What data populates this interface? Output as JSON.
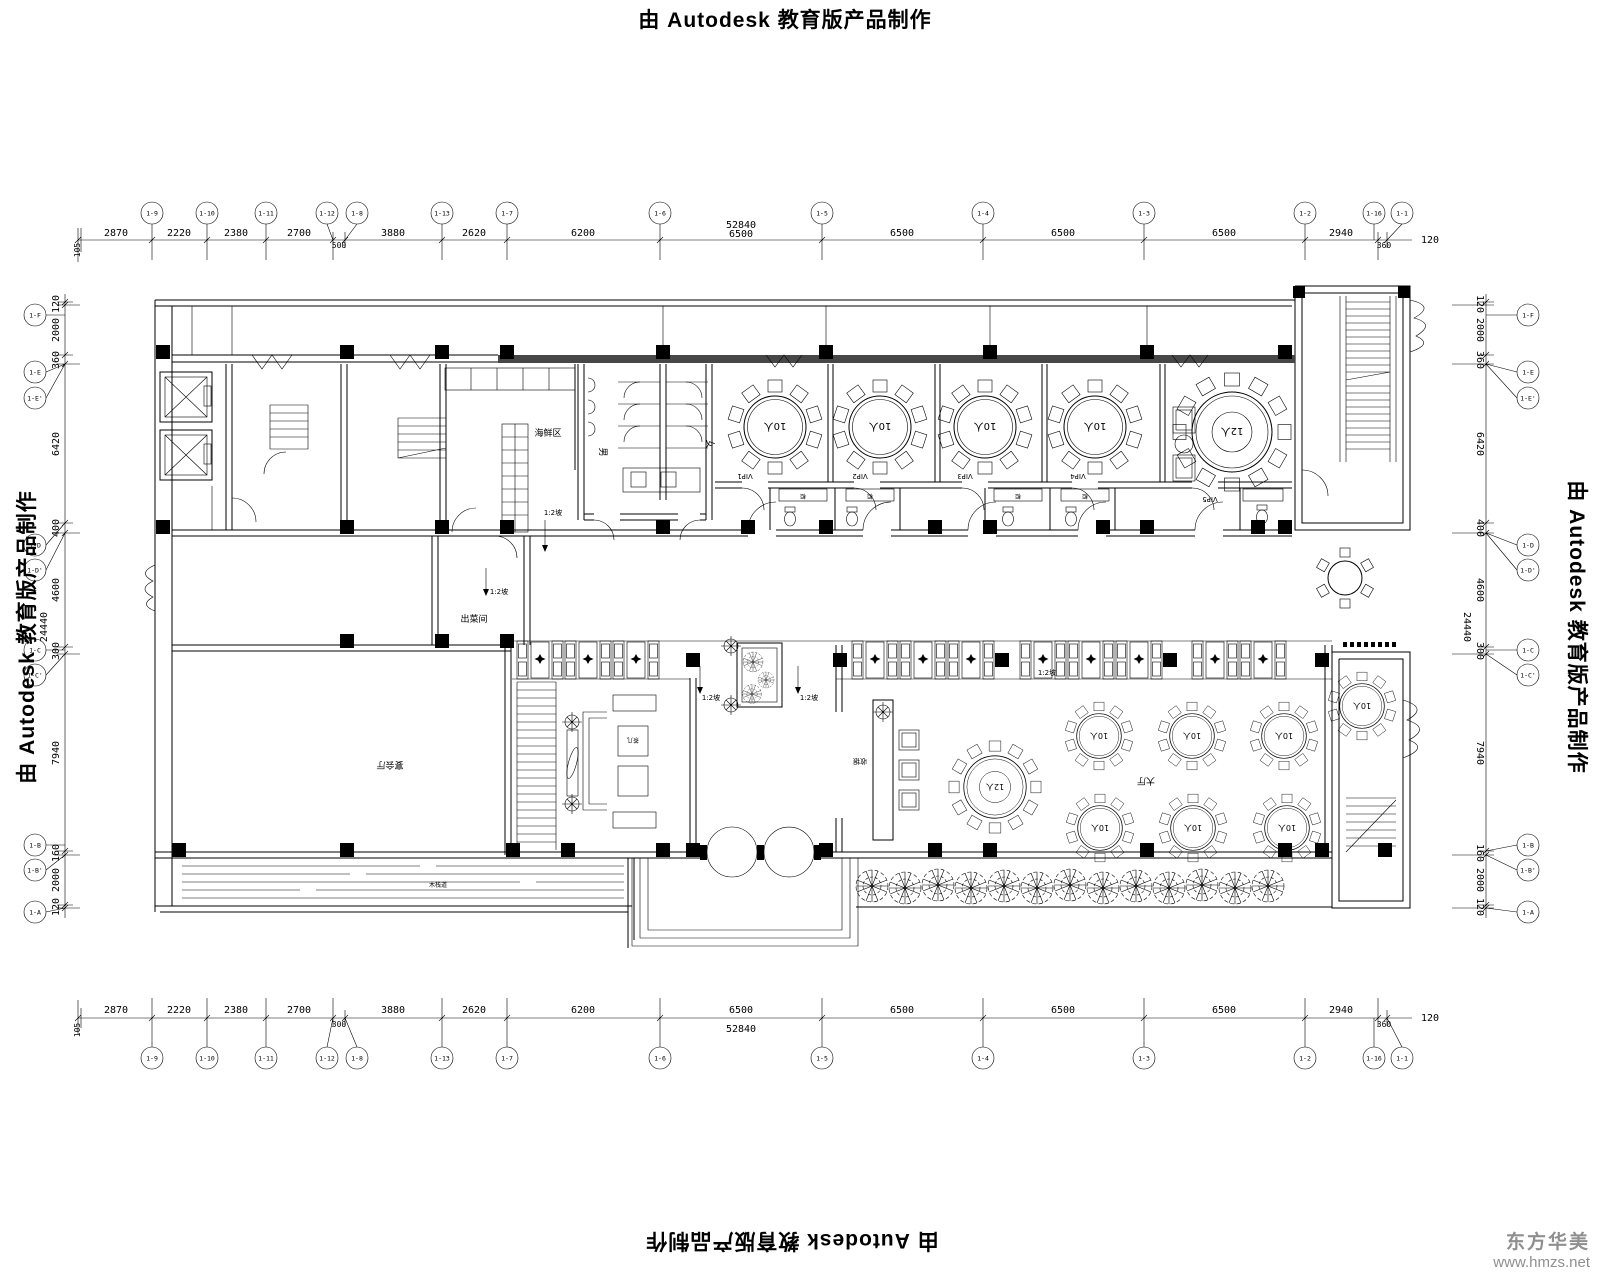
{
  "sheet": {
    "title_prefix": "由",
    "title_brand": "Autodesk",
    "title_suffix": "教育版产品制作"
  },
  "watermark": {
    "name": "东方华美",
    "url": "www.hmzs.net"
  },
  "dims": {
    "top": [
      "105",
      "2870",
      "2220",
      "2380",
      "2700",
      "500",
      "3880",
      "2620",
      "6200",
      "6500",
      "6500",
      "6500",
      "6500",
      "2940",
      "360"
    ],
    "top_total": "52840",
    "top_out": "120",
    "bottom": [
      "105",
      "2870",
      "2220",
      "2380",
      "2700",
      "300",
      "3880",
      "2620",
      "6200",
      "6500",
      "6500",
      "6500",
      "6500",
      "2940",
      "360"
    ],
    "bottom_total": "52840",
    "bottom_out": "120",
    "side": [
      "120",
      "2000",
      "360",
      "6420",
      "400",
      "4600",
      "300",
      "7940",
      "160",
      "2000",
      "120"
    ],
    "side_total": "24440"
  },
  "axes": {
    "top": [
      "1-9",
      "1-10",
      "1-11",
      "1-12",
      "1-8",
      "1-13",
      "1-7",
      "1-6",
      "1-5",
      "1-4",
      "1-3",
      "1-2",
      "1-16",
      "1-1"
    ],
    "side": [
      "1-F",
      "1-E",
      "1-E'",
      "1-D",
      "1-D'",
      "1-C",
      "1-C'",
      "1-B",
      "1-B'",
      "1-A"
    ]
  },
  "labels": {
    "seafood": "海鲜区",
    "wc_m": "男",
    "wc_f": "女",
    "serving": "出菜间",
    "slope": "1:2坡",
    "cashier": "收银",
    "hall": "大厅",
    "banquet": "宴会厅",
    "tea_table": "茶几",
    "deck": "木栈道",
    "cabinet": "柜",
    "vip1": "VIP1",
    "vip2": "VIP2",
    "vip3": "VIP3",
    "vip4": "VIP4",
    "vip5": "VIP5"
  },
  "tables": {
    "t10": "10人",
    "t12": "12人"
  }
}
